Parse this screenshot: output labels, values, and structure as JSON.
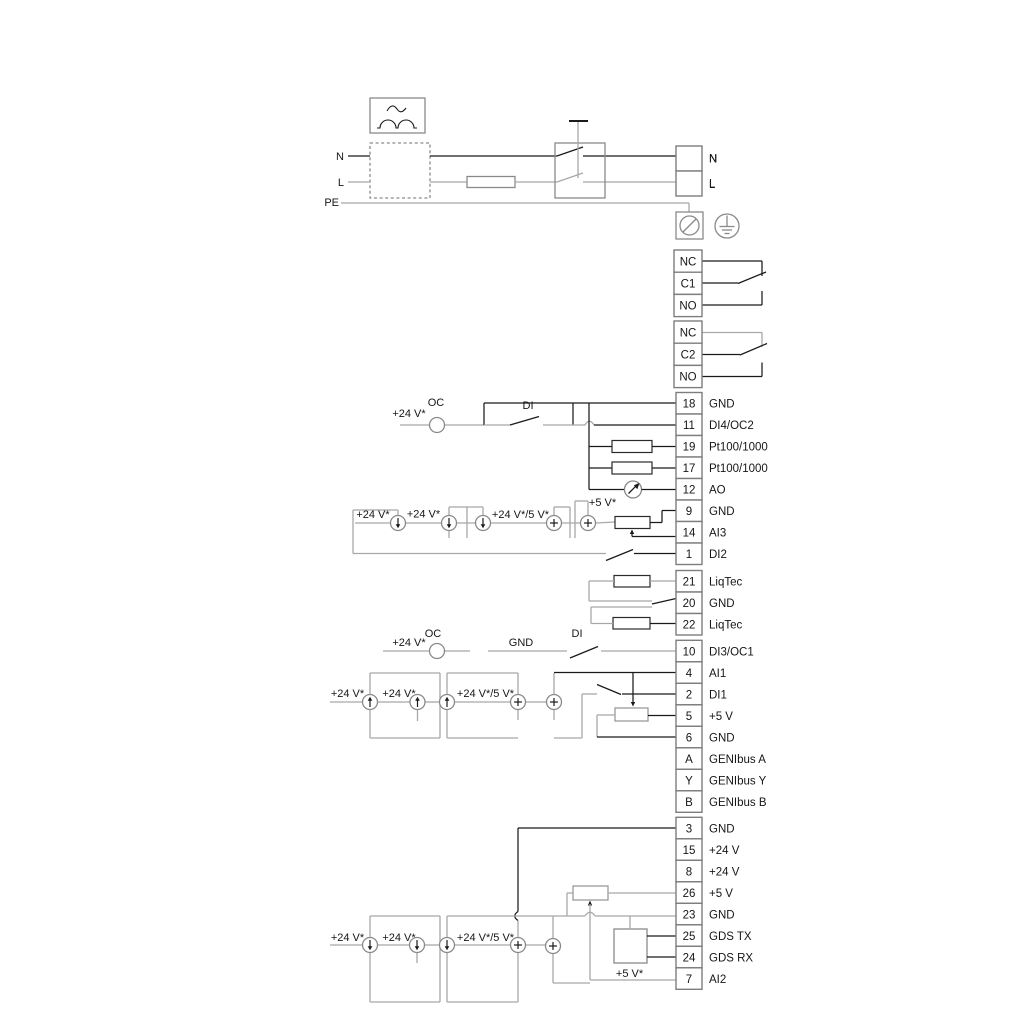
{
  "diagram_title": "pump-wiring-diagram",
  "colors": {
    "background": "#ffffff",
    "wire_dark": "#1a1a1a",
    "wire_gray": "#a8a8a8",
    "component_stroke": "#8a8a8a",
    "text": "#161616"
  },
  "icons": {
    "rectifier_icon": "box with sine wave over two rectified humps",
    "fuse_icon": "rectangle on wire",
    "double_pole_switch_icon": "box with two linked switch blades",
    "screw_terminal_icon": "boxed circle with diagonal slash",
    "protective_earth_icon": "circle with ground bars",
    "open_collector_icon": "empty circle",
    "current_source_down_icon": "circle with downward arrow",
    "current_source_up_icon": "circle with upward arrow",
    "voltage_source_icon": "circle with plus",
    "analog_meter_icon": "circle with needle arrow",
    "resistor_icon": "rectangle",
    "potentiometer_icon": "rectangle with wiper arrow",
    "switch_contact_icon": "diagonal blade over wire gap"
  },
  "top_section": {
    "left_labels": [
      "N",
      "L",
      "PE"
    ],
    "right_terminal_labels": [
      "N",
      "L"
    ]
  },
  "relay_blocks": [
    {
      "cells": [
        "NC",
        "C1",
        "NO"
      ]
    },
    {
      "cells": [
        "NC",
        "C2",
        "NO"
      ]
    }
  ],
  "terminal_groups": [
    {
      "name": "mains-out",
      "x": 676,
      "y": 146,
      "w": 26,
      "cell_h": 25,
      "cells": [
        {
          "n": "",
          "label": "N"
        },
        {
          "n": "",
          "label": "L"
        }
      ]
    },
    {
      "name": "relay-1",
      "x": 674,
      "y": 250,
      "w": 28,
      "cell_h": 22.2,
      "cells": [
        {
          "n": "NC",
          "label": ""
        },
        {
          "n": "C1",
          "label": ""
        },
        {
          "n": "NO",
          "label": ""
        }
      ]
    },
    {
      "name": "relay-2",
      "x": 674,
      "y": 321,
      "w": 28,
      "cell_h": 22.2,
      "cells": [
        {
          "n": "NC",
          "label": ""
        },
        {
          "n": "C2",
          "label": ""
        },
        {
          "n": "NO",
          "label": ""
        }
      ]
    },
    {
      "name": "io-upper",
      "x": 676,
      "y": 392.5,
      "w": 26,
      "cell_h": 21.5,
      "cells": [
        {
          "n": "18",
          "label": "GND"
        },
        {
          "n": "11",
          "label": "DI4/OC2"
        },
        {
          "n": "19",
          "label": "Pt100/1000"
        },
        {
          "n": "17",
          "label": "Pt100/1000"
        },
        {
          "n": "12",
          "label": "AO"
        },
        {
          "n": "9",
          "label": "GND"
        },
        {
          "n": "14",
          "label": "AI3"
        },
        {
          "n": "1",
          "label": "DI2"
        }
      ]
    },
    {
      "name": "liqtec",
      "x": 676,
      "y": 570.5,
      "w": 26,
      "cell_h": 21.5,
      "cells": [
        {
          "n": "21",
          "label": "LiqTec"
        },
        {
          "n": "20",
          "label": "GND"
        },
        {
          "n": "22",
          "label": "LiqTec"
        }
      ]
    },
    {
      "name": "io-middle",
      "x": 676,
      "y": 640.3,
      "w": 26,
      "cell_h": 21.5,
      "cells": [
        {
          "n": "10",
          "label": "DI3/OC1"
        },
        {
          "n": "4",
          "label": "AI1"
        },
        {
          "n": "2",
          "label": "DI1"
        },
        {
          "n": "5",
          "label": "+5 V"
        },
        {
          "n": "6",
          "label": "GND"
        },
        {
          "n": "A",
          "label": "GENIbus A"
        },
        {
          "n": "Y",
          "label": "GENIbus Y"
        },
        {
          "n": "B",
          "label": "GENIbus B"
        }
      ]
    },
    {
      "name": "io-lower",
      "x": 676,
      "y": 817.3,
      "w": 26,
      "cell_h": 21.5,
      "cells": [
        {
          "n": "3",
          "label": "GND"
        },
        {
          "n": "15",
          "label": "+24 V"
        },
        {
          "n": "8",
          "label": "+24 V"
        },
        {
          "n": "26",
          "label": "+5 V"
        },
        {
          "n": "23",
          "label": "GND"
        },
        {
          "n": "25",
          "label": "GDS TX"
        },
        {
          "n": "24",
          "label": "GDS RX"
        },
        {
          "n": "7",
          "label": "AI2"
        }
      ]
    }
  ],
  "floating_labels": [
    {
      "text": "N",
      "x": 344,
      "y": 160,
      "anchor": "end"
    },
    {
      "text": "L",
      "x": 344,
      "y": 186,
      "anchor": "end"
    },
    {
      "text": "PE",
      "x": 339,
      "y": 206,
      "anchor": "end"
    },
    {
      "text": "N",
      "x": 709,
      "y": 162,
      "anchor": "start"
    },
    {
      "text": "L",
      "x": 709,
      "y": 188,
      "anchor": "start"
    },
    {
      "text": "+24 V*",
      "x": 409,
      "y": 417,
      "anchor": "middle"
    },
    {
      "text": "OC",
      "x": 436,
      "y": 406,
      "anchor": "middle"
    },
    {
      "text": "DI",
      "x": 528,
      "y": 409,
      "anchor": "middle"
    },
    {
      "text": "+24 V*",
      "x": 373,
      "y": 518,
      "anchor": "middle"
    },
    {
      "text": "+24 V*",
      "x": 423.5,
      "y": 517.5,
      "anchor": "middle"
    },
    {
      "text": "+24 V*/5 V*",
      "x": 520.5,
      "y": 518,
      "anchor": "middle"
    },
    {
      "text": "+5 V*",
      "x": 602.5,
      "y": 506,
      "anchor": "middle"
    },
    {
      "text": "+24 V*",
      "x": 409,
      "y": 646,
      "anchor": "middle"
    },
    {
      "text": "OC",
      "x": 433,
      "y": 637,
      "anchor": "middle"
    },
    {
      "text": "GND",
      "x": 521,
      "y": 646,
      "anchor": "middle"
    },
    {
      "text": "DI",
      "x": 577,
      "y": 637,
      "anchor": "middle"
    },
    {
      "text": "+24 V*",
      "x": 347.5,
      "y": 697,
      "anchor": "middle"
    },
    {
      "text": "+24 V*",
      "x": 399,
      "y": 697,
      "anchor": "middle"
    },
    {
      "text": "+24 V*/5 V*",
      "x": 485.5,
      "y": 697,
      "anchor": "middle"
    },
    {
      "text": "+24 V*",
      "x": 347.5,
      "y": 941,
      "anchor": "middle"
    },
    {
      "text": "+24 V*",
      "x": 399,
      "y": 941,
      "anchor": "middle"
    },
    {
      "text": "+24 V*/5 V*",
      "x": 485.5,
      "y": 941,
      "anchor": "middle"
    },
    {
      "text": "+5 V*",
      "x": 629.5,
      "y": 977,
      "anchor": "middle"
    }
  ]
}
